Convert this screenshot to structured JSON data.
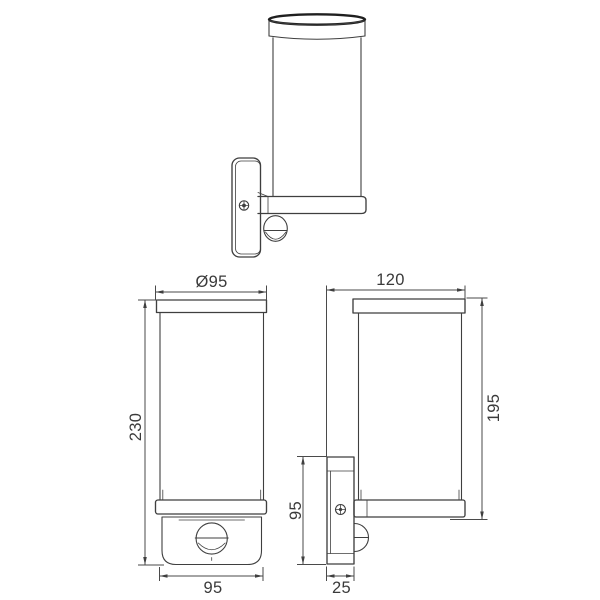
{
  "drawing": {
    "background_color": "#ffffff",
    "line_color": "#3f3f3f",
    "views": {
      "front": {
        "diameter": "Ø95",
        "height": "230",
        "width": "95"
      },
      "side": {
        "depth": "120",
        "height": "195",
        "bracket_height": "95",
        "bracket_depth": "25"
      }
    }
  }
}
